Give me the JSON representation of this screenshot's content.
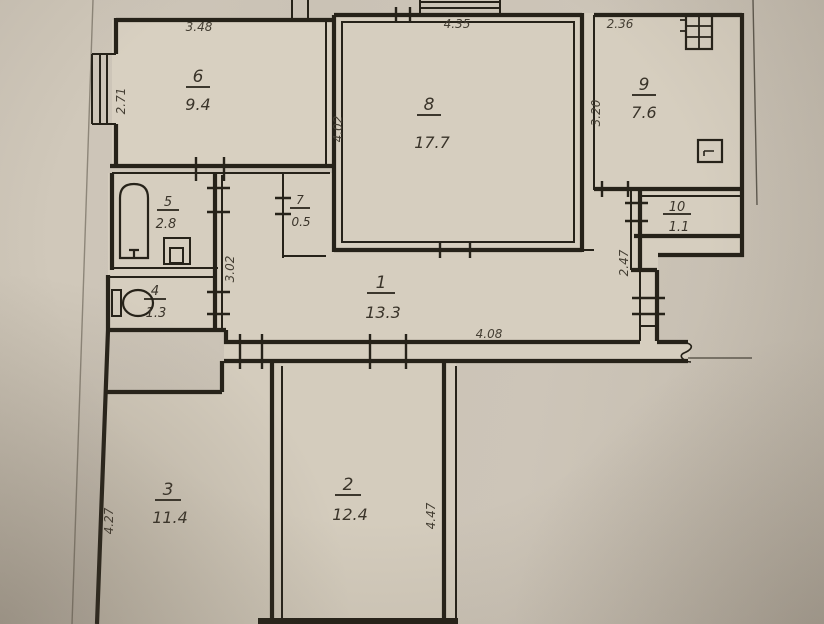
{
  "plan": {
    "type": "apartment-floor-plan",
    "rooms": [
      {
        "number": "1",
        "area": "13.3"
      },
      {
        "number": "2",
        "area": "12.4"
      },
      {
        "number": "3",
        "area": "11.4"
      },
      {
        "number": "4",
        "area": "1.3"
      },
      {
        "number": "5",
        "area": "2.8"
      },
      {
        "number": "6",
        "area": "9.4"
      },
      {
        "number": "7",
        "area": "0.5"
      },
      {
        "number": "8",
        "area": "17.7"
      },
      {
        "number": "9",
        "area": "7.6"
      },
      {
        "number": "10",
        "area": "1.1"
      }
    ],
    "dimensions": {
      "room6_top": "3.48",
      "room6_left": "2.71",
      "room8_top": "4.35",
      "room8_left": "4.02",
      "room9_top": "2.36",
      "room9_left": "3.20",
      "hall_right": "2.47",
      "corridor_bottom": "4.08",
      "hall_left": "3.02",
      "room3_left": "4.27",
      "room2_right": "4.47"
    },
    "colors": {
      "paper": "#cac2b5",
      "room_fill": "#d7cfc0",
      "ink": "#262219"
    }
  }
}
